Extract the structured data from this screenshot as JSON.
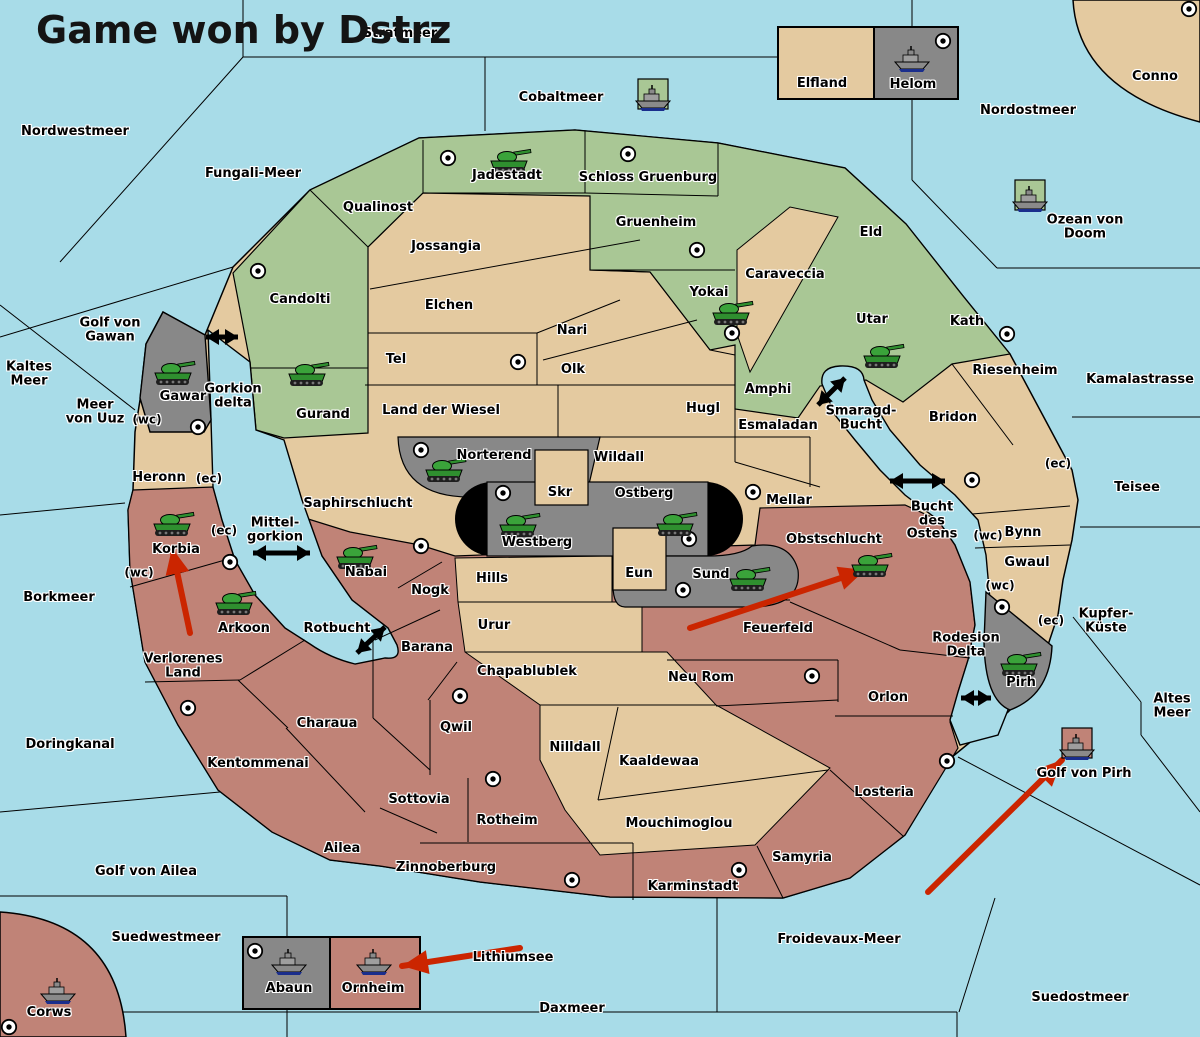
{
  "title": "Game won by Dstrz",
  "colors": {
    "sea": "#a8dce8",
    "land_tan": "#e4caa0",
    "land_green": "#a9c795",
    "land_red": "#c08377",
    "land_gray": "#888888",
    "lens_black": "#000000",
    "arrow_red": "#cb2500",
    "arrow_black": "#000000",
    "tank_green": "#2f8f2f",
    "ship_gray": "#8a8a8a"
  },
  "labels": [
    [
      "sea-nordwestmeer",
      "Nordwestmeer",
      75,
      132
    ],
    [
      "sea-stratmeer",
      "Stratmeer",
      400,
      34
    ],
    [
      "sea-cobaltmeer",
      "Cobaltmeer",
      561,
      98
    ],
    [
      "sea-nordostmeer",
      "Nordostmeer",
      1028,
      111
    ],
    [
      "territory-conno",
      "Conno",
      1155,
      77
    ],
    [
      "sea-fungali-meer",
      "Fungali-Meer",
      253,
      174
    ],
    [
      "sea-ozean-von-doom",
      "Ozean von Doom",
      1085,
      227
    ],
    [
      "sea-kaltes-meer",
      "Kaltes\nMeer",
      29,
      374
    ],
    [
      "sea-golf-von-gawan",
      "Golf von\nGawan",
      110,
      330
    ],
    [
      "sea-meer-von-uuz",
      "Meer\nvon Uuz",
      95,
      412
    ],
    [
      "sea-gorkion-delta",
      "Gorkion\ndelta",
      233,
      396
    ],
    [
      "sea-kamalastrasse",
      "Kamalastrasse",
      1140,
      380
    ],
    [
      "sea-teisee",
      "Teisee",
      1137,
      488
    ],
    [
      "sea-smaragd-bucht",
      "Smaragd-\nBucht",
      861,
      418
    ],
    [
      "sea-bucht-des-ostens",
      "Bucht\ndes\nOstens",
      932,
      521
    ],
    [
      "sea-mittel-gorkion",
      "Mittel-\ngorkion",
      275,
      530
    ],
    [
      "sea-borkmeer",
      "Borkmeer",
      59,
      598
    ],
    [
      "sea-rotbucht",
      "Rotbucht",
      337,
      629
    ],
    [
      "sea-kupfer-kueste",
      "Kupfer-\nKüste",
      1106,
      621
    ],
    [
      "sea-altes-meer",
      "Altes\nMeer",
      1172,
      706
    ],
    [
      "sea-rodesion-delta",
      "Rodesion\nDelta",
      966,
      645
    ],
    [
      "sea-doringkanal",
      "Doringkanal",
      70,
      745
    ],
    [
      "sea-golf-von-ailea",
      "Golf von Ailea",
      146,
      872
    ],
    [
      "sea-suedwestmeer",
      "Suedwestmeer",
      166,
      938
    ],
    [
      "sea-golf-von-pirh",
      "Golf von Pirh",
      1084,
      774
    ],
    [
      "sea-lithiumsee",
      "Lithiumsee",
      513,
      958
    ],
    [
      "sea-froidevaux-meer",
      "Froidevaux-Meer",
      839,
      940
    ],
    [
      "sea-daxmeer",
      "Daxmeer",
      572,
      1009
    ],
    [
      "sea-suedostmeer",
      "Suedostmeer",
      1080,
      998
    ],
    [
      "territory-elfland",
      "Elfland",
      822,
      84
    ],
    [
      "territory-helom",
      "Helom",
      913,
      85
    ],
    [
      "territory-abaun",
      "Abaun",
      289,
      989
    ],
    [
      "territory-ornheim",
      "Ornheim",
      373,
      989
    ],
    [
      "territory-corws",
      "Corws",
      49,
      1013
    ],
    [
      "territory-qualinost",
      "Qualinost",
      378,
      208
    ],
    [
      "territory-jadestadt",
      "Jadestadt",
      507,
      176
    ],
    [
      "territory-schloss-gruenburg",
      "Schloss Gruenburg",
      648,
      178
    ],
    [
      "territory-gruenheim",
      "Gruenheim",
      656,
      223
    ],
    [
      "territory-candolti",
      "Candolti",
      300,
      300
    ],
    [
      "territory-yokai",
      "Yokai",
      709,
      293
    ],
    [
      "territory-eld",
      "Eld",
      871,
      233
    ],
    [
      "territory-utar",
      "Utar",
      872,
      320
    ],
    [
      "territory-kath",
      "Kath",
      967,
      322
    ],
    [
      "territory-amphi",
      "Amphi",
      768,
      390
    ],
    [
      "territory-gurand",
      "Gurand",
      323,
      415
    ],
    [
      "territory-jossangia",
      "Jossangia",
      446,
      247
    ],
    [
      "territory-elchen",
      "Elchen",
      449,
      306
    ],
    [
      "territory-caraveccia",
      "Caraveccia",
      785,
      275
    ],
    [
      "territory-nari",
      "Nari",
      572,
      331
    ],
    [
      "territory-tel",
      "Tel",
      396,
      360
    ],
    [
      "territory-olk",
      "Olk",
      573,
      370
    ],
    [
      "territory-land-der-wiesel",
      "Land der Wiesel",
      441,
      411
    ],
    [
      "territory-hugl",
      "Hugl",
      703,
      409
    ],
    [
      "territory-esmaladan",
      "Esmaladan",
      778,
      426
    ],
    [
      "territory-riesenheim",
      "Riesenheim",
      1015,
      371
    ],
    [
      "territory-bridon",
      "Bridon",
      953,
      418
    ],
    [
      "territory-wildall",
      "Wildall",
      619,
      458
    ],
    [
      "territory-skr",
      "Skr",
      560,
      493
    ],
    [
      "territory-mellar",
      "Mellar",
      789,
      501
    ],
    [
      "territory-bynn",
      "Bynn",
      1023,
      533
    ],
    [
      "territory-gwaul",
      "Gwaul",
      1027,
      563
    ],
    [
      "territory-eun",
      "Eun",
      639,
      574
    ],
    [
      "territory-hills",
      "Hills",
      492,
      579
    ],
    [
      "territory-urur",
      "Urur",
      494,
      626
    ],
    [
      "territory-chapablublek",
      "Chapablublek",
      527,
      672
    ],
    [
      "territory-nilldall",
      "Nilldall",
      575,
      748
    ],
    [
      "territory-kaaldewaa",
      "Kaaldewaa",
      659,
      762
    ],
    [
      "territory-mouchimoglou",
      "Mouchimoglou",
      679,
      824
    ],
    [
      "territory-gawar",
      "Gawar",
      183,
      397
    ],
    [
      "territory-norterend",
      "Norterend",
      494,
      456
    ],
    [
      "territory-westberg",
      "Westberg",
      537,
      543
    ],
    [
      "territory-ostberg",
      "Ostberg",
      644,
      494
    ],
    [
      "territory-sund",
      "Sund",
      711,
      575
    ],
    [
      "territory-pirh",
      "Pirh",
      1021,
      683
    ],
    [
      "territory-heronn",
      "Heronn",
      159,
      478
    ],
    [
      "territory-korbia",
      "Korbia",
      176,
      550
    ],
    [
      "territory-nabai",
      "Nabai",
      366,
      573
    ],
    [
      "territory-arkoon",
      "Arkoon",
      244,
      629
    ],
    [
      "territory-verlorenes-land",
      "Verlorenes\nLand",
      183,
      666
    ],
    [
      "territory-nogk",
      "Nogk",
      430,
      591
    ],
    [
      "territory-barana",
      "Barana",
      427,
      648
    ],
    [
      "territory-obstschlucht",
      "Obstschlucht",
      834,
      540
    ],
    [
      "territory-feuerfeld",
      "Feuerfeld",
      778,
      629
    ],
    [
      "territory-neu-rom",
      "Neu Rom",
      701,
      678
    ],
    [
      "territory-orlon",
      "Orlon",
      888,
      698
    ],
    [
      "territory-charaua",
      "Charaua",
      327,
      724
    ],
    [
      "territory-qwil",
      "Qwil",
      456,
      728
    ],
    [
      "territory-kentommenai",
      "Kentommenai",
      258,
      764
    ],
    [
      "territory-sottovia",
      "Sottovia",
      419,
      800
    ],
    [
      "territory-rotheim",
      "Rotheim",
      507,
      821
    ],
    [
      "territory-losteria",
      "Losteria",
      884,
      793
    ],
    [
      "territory-ailea",
      "Ailea",
      342,
      849
    ],
    [
      "territory-zinnoberburg",
      "Zinnoberburg",
      446,
      868
    ],
    [
      "territory-samyria",
      "Samyria",
      802,
      858
    ],
    [
      "territory-karminstadt",
      "Karminstadt",
      693,
      887
    ],
    [
      "territory-saphirschlucht",
      "Saphirschlucht",
      358,
      504
    ],
    [
      "coast-marker-wc-uuz",
      "(wc)",
      147,
      420,
      12
    ],
    [
      "coast-marker-ec-heronn",
      "(ec)",
      209,
      479,
      12
    ],
    [
      "coast-marker-ec-korbia",
      "(ec)",
      224,
      531,
      12
    ],
    [
      "coast-marker-wc-korbia",
      "(wc)",
      139,
      573,
      12
    ],
    [
      "coast-marker-wc-bynn",
      "(wc)",
      988,
      536,
      12
    ],
    [
      "coast-marker-wc-gwaul",
      "(wc)",
      1000,
      586,
      12
    ],
    [
      "coast-marker-ec-gwaul",
      "(ec)",
      1051,
      621,
      12
    ],
    [
      "coast-marker-ec-bridon",
      "(ec)",
      1058,
      464,
      12
    ]
  ],
  "supply_centers": [
    [
      1189,
      9
    ],
    [
      943,
      41
    ],
    [
      448,
      158
    ],
    [
      628,
      154
    ],
    [
      258,
      271
    ],
    [
      697,
      250
    ],
    [
      732,
      333
    ],
    [
      518,
      362
    ],
    [
      1007,
      334
    ],
    [
      972,
      480
    ],
    [
      198,
      427
    ],
    [
      421,
      450
    ],
    [
      503,
      493
    ],
    [
      689,
      539
    ],
    [
      753,
      492
    ],
    [
      683,
      590
    ],
    [
      421,
      546
    ],
    [
      230,
      562
    ],
    [
      188,
      708
    ],
    [
      460,
      696
    ],
    [
      493,
      779
    ],
    [
      572,
      880
    ],
    [
      739,
      870
    ],
    [
      947,
      761
    ],
    [
      1002,
      607
    ],
    [
      812,
      676
    ],
    [
      9,
      1027
    ],
    [
      255,
      951
    ]
  ],
  "tanks": [
    [
      510,
      161
    ],
    [
      732,
      313
    ],
    [
      883,
      356
    ],
    [
      308,
      374
    ],
    [
      174,
      373
    ],
    [
      445,
      470
    ],
    [
      519,
      525
    ],
    [
      676,
      524
    ],
    [
      173,
      524
    ],
    [
      356,
      557
    ],
    [
      235,
      603
    ],
    [
      749,
      579
    ],
    [
      871,
      565
    ],
    [
      1020,
      664
    ]
  ],
  "ships": [
    {
      "x": 653,
      "y": 99,
      "tile": "land_green"
    },
    {
      "x": 912,
      "y": 60,
      "tile": null
    },
    {
      "x": 1030,
      "y": 200,
      "tile": "land_green"
    },
    {
      "x": 1077,
      "y": 748,
      "tile": "land_red"
    },
    {
      "x": 289,
      "y": 963,
      "tile": null
    },
    {
      "x": 374,
      "y": 963,
      "tile": null
    },
    {
      "x": 58,
      "y": 992,
      "tile": null
    }
  ],
  "black_arrows": [
    [
      206,
      337,
      238,
      337
    ],
    [
      818,
      405,
      845,
      378
    ],
    [
      890,
      481,
      945,
      481
    ],
    [
      253,
      553,
      310,
      553
    ],
    [
      357,
      653,
      385,
      627
    ],
    [
      961,
      698,
      991,
      698
    ]
  ],
  "red_arrows": [
    [
      190,
      633,
      172,
      548
    ],
    [
      690,
      628,
      865,
      570
    ],
    [
      928,
      892,
      1062,
      760
    ],
    [
      520,
      948,
      402,
      966
    ]
  ]
}
